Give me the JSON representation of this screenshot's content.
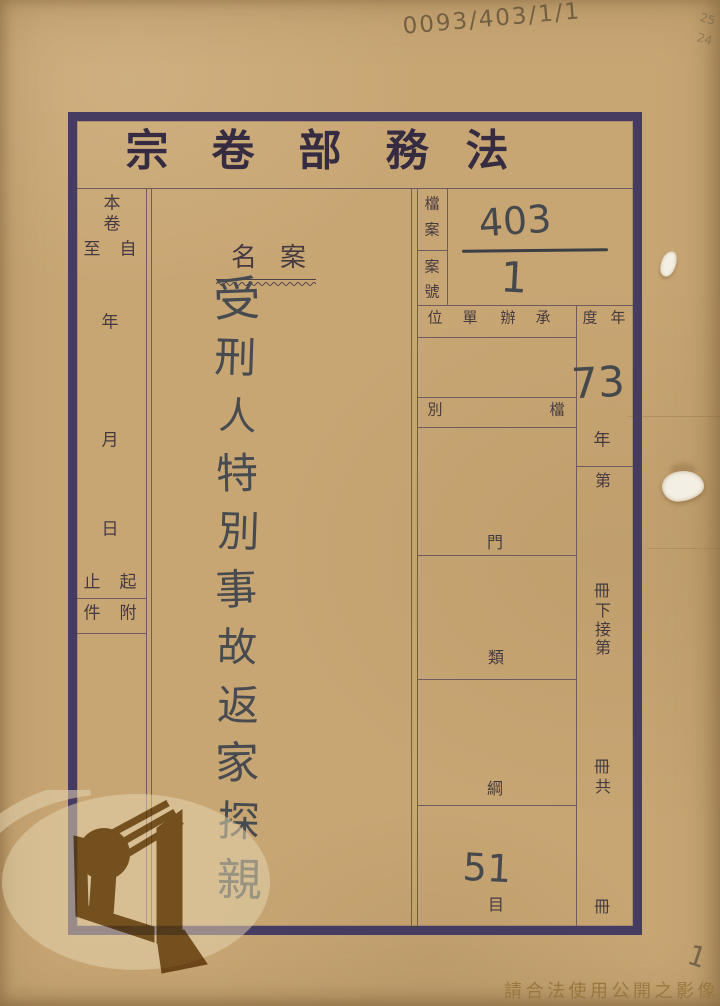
{
  "title": {
    "chars": [
      "宗",
      "卷",
      "部",
      "務",
      "法"
    ]
  },
  "left_column": {
    "volume_top": "本",
    "volume_bottom": "卷",
    "to": "至",
    "from": "自",
    "year": "年",
    "month": "月",
    "day": "日",
    "end": "止",
    "start": "起",
    "attach_item": "件",
    "attach": "附"
  },
  "case_name": {
    "label_chars": [
      "名",
      "案"
    ],
    "chars": [
      "受",
      "刑",
      "人",
      "特",
      "別",
      "事",
      "故",
      "返",
      "家",
      "探",
      "親"
    ],
    "full": "受刑人特別事故返家探親"
  },
  "file_number": {
    "label_chars": [
      "檔",
      "案",
      "案",
      "號"
    ],
    "top": "403",
    "bottom": "1"
  },
  "grid": {
    "unit_header_chars": [
      "位",
      "單",
      "辦",
      "承"
    ],
    "year_header_chars": [
      "度",
      "年"
    ],
    "file_category_left": "別",
    "file_category_right": "檔",
    "division": "門",
    "class": "類",
    "section": "綱",
    "item": "目",
    "item_value": "51",
    "year_value": "73",
    "year_suffix": "年"
  },
  "volume_column": {
    "chars": [
      "第",
      "冊",
      "下",
      "接",
      "第",
      "冊",
      "共",
      "冊"
    ]
  },
  "annotations": {
    "archive_code": "0093/403/1/1",
    "corner_note_1": "25",
    "corner_note_2": "24",
    "page_number": "1"
  },
  "watermark": {
    "logo": "archives-open-book-emblem",
    "usage_notice": "請合法使用公開之影像"
  },
  "colors": {
    "paper": "#c8a674",
    "frame": "#463b60",
    "rule_line": "#6f5b60",
    "ink": "#45494e",
    "pencil": "#75644e",
    "notice_text": "#9b7a48"
  }
}
